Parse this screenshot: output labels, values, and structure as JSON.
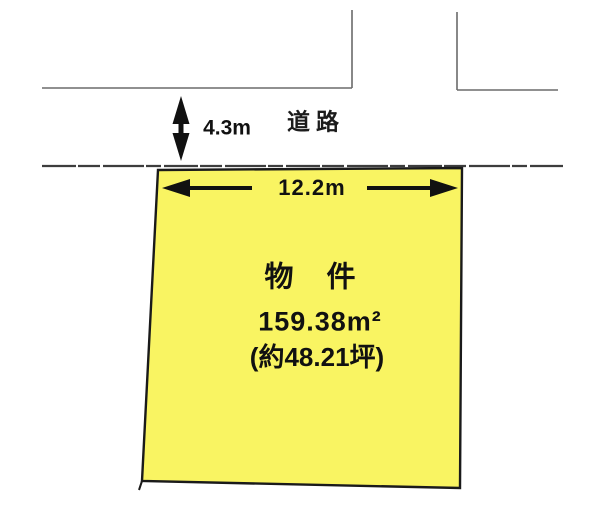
{
  "road": {
    "name": "道路",
    "width": "4.3m"
  },
  "plot": {
    "title": "物　件",
    "area_sqm": "159.38m²",
    "area_tsubo": "(約48.21坪)",
    "frontage": "12.2m"
  },
  "colors": {
    "plot_fill": "#f9f462",
    "plot_border": "#1a1a1a",
    "boundary_line": "#6b6b6b",
    "arrow": "#111111",
    "background": "#ffffff"
  }
}
